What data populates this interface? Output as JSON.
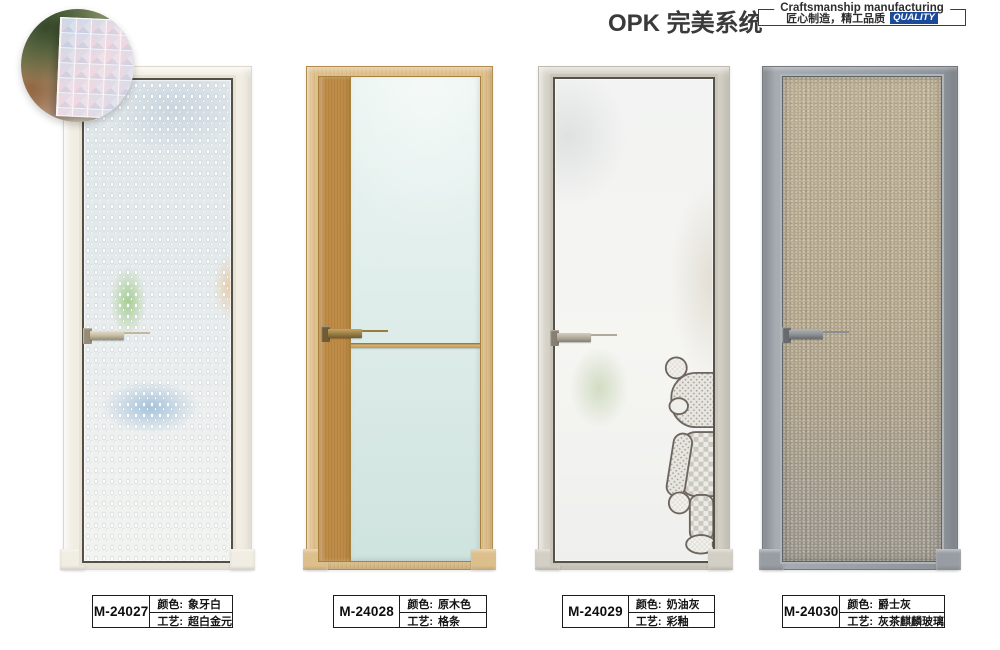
{
  "header": {
    "title": "OPK 完美系统",
    "cert_box": {
      "line1": "Craftsmanship manufacturing",
      "line2": "匠心制造，精工品质",
      "quality": "QUALITY",
      "quality_color": "#1b4a9b"
    }
  },
  "field_labels": {
    "color_prefix": "颜色:",
    "craft_prefix": "工艺:"
  },
  "products": [
    {
      "model": "M-24027",
      "color": "象牙白",
      "craft": "超白金元",
      "frame_hex": "#f1ede3"
    },
    {
      "model": "M-24028",
      "color": "原木色",
      "craft": "格条",
      "frame_hex": "#ddbf8b"
    },
    {
      "model": "M-24029",
      "color": "奶油灰",
      "craft": "彩釉",
      "frame_hex": "#d3cfc4"
    },
    {
      "model": "M-24030",
      "color": "爵士灰",
      "craft": "灰茶麒麟玻璃",
      "frame_hex": "#979da3"
    }
  ]
}
